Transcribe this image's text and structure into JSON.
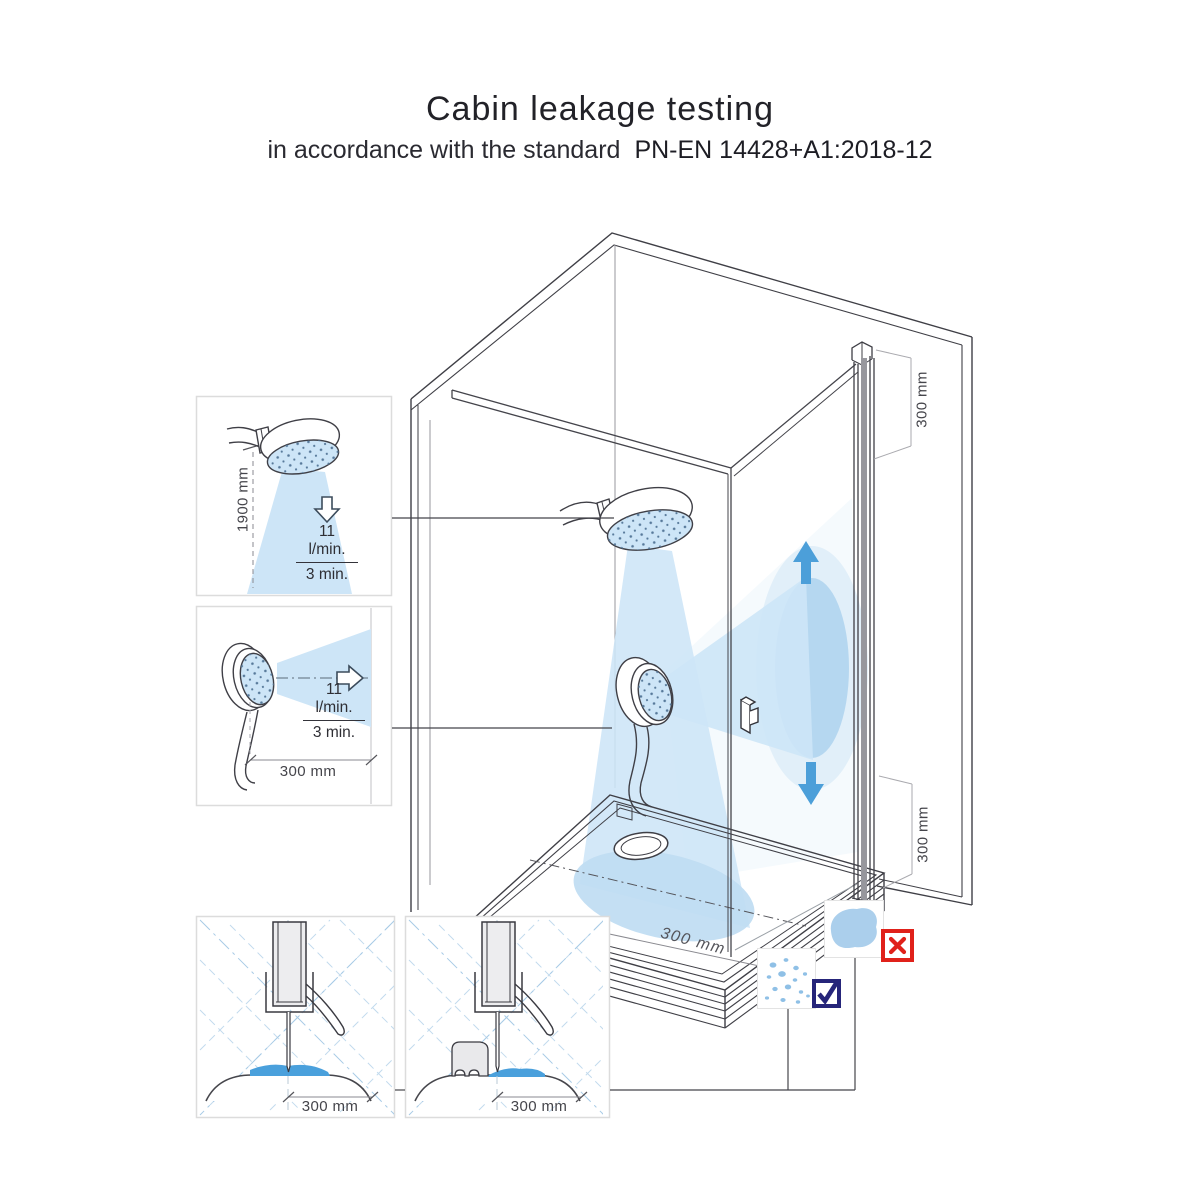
{
  "header": {
    "title": "Cabin leakage testing",
    "subtitle": "in accordance with the standard",
    "standard": "PN-EN 14428+A1:2018-12"
  },
  "insets": {
    "vertical_spray_test": {
      "height": "1900 mm",
      "flow_rate": "11 l/min.",
      "duration": "3 min."
    },
    "horizontal_spray_test": {
      "distance": "300 mm",
      "flow_rate": "11 l/min.",
      "duration": "3 min."
    },
    "bottom_seal_detail_left": {
      "distance": "300 mm"
    },
    "bottom_seal_detail_right": {
      "distance": "300 mm"
    }
  },
  "cabin": {
    "door_top_dimension": "300 mm",
    "door_bottom_dimension": "300 mm",
    "tray_spray_dimension": "300 mm"
  },
  "result_indicators": {
    "outside_leak": {
      "icon": "fail-cross-icon",
      "color": "#e0211a"
    },
    "inside_drops": {
      "icon": "pass-check-icon",
      "color": "#26257a"
    }
  },
  "icons": {
    "flow_direction_down": "hollow-down-arrow",
    "flow_direction_right": "hollow-right-arrow",
    "sweep_up": "solid-up-arrow",
    "sweep_down": "solid-down-arrow"
  },
  "colors": {
    "spray_blue": "#cde5f7",
    "water_blue": "#4aa0dc",
    "arrow_blue": "#4c9fd9",
    "line_dark": "#3f3f46"
  }
}
